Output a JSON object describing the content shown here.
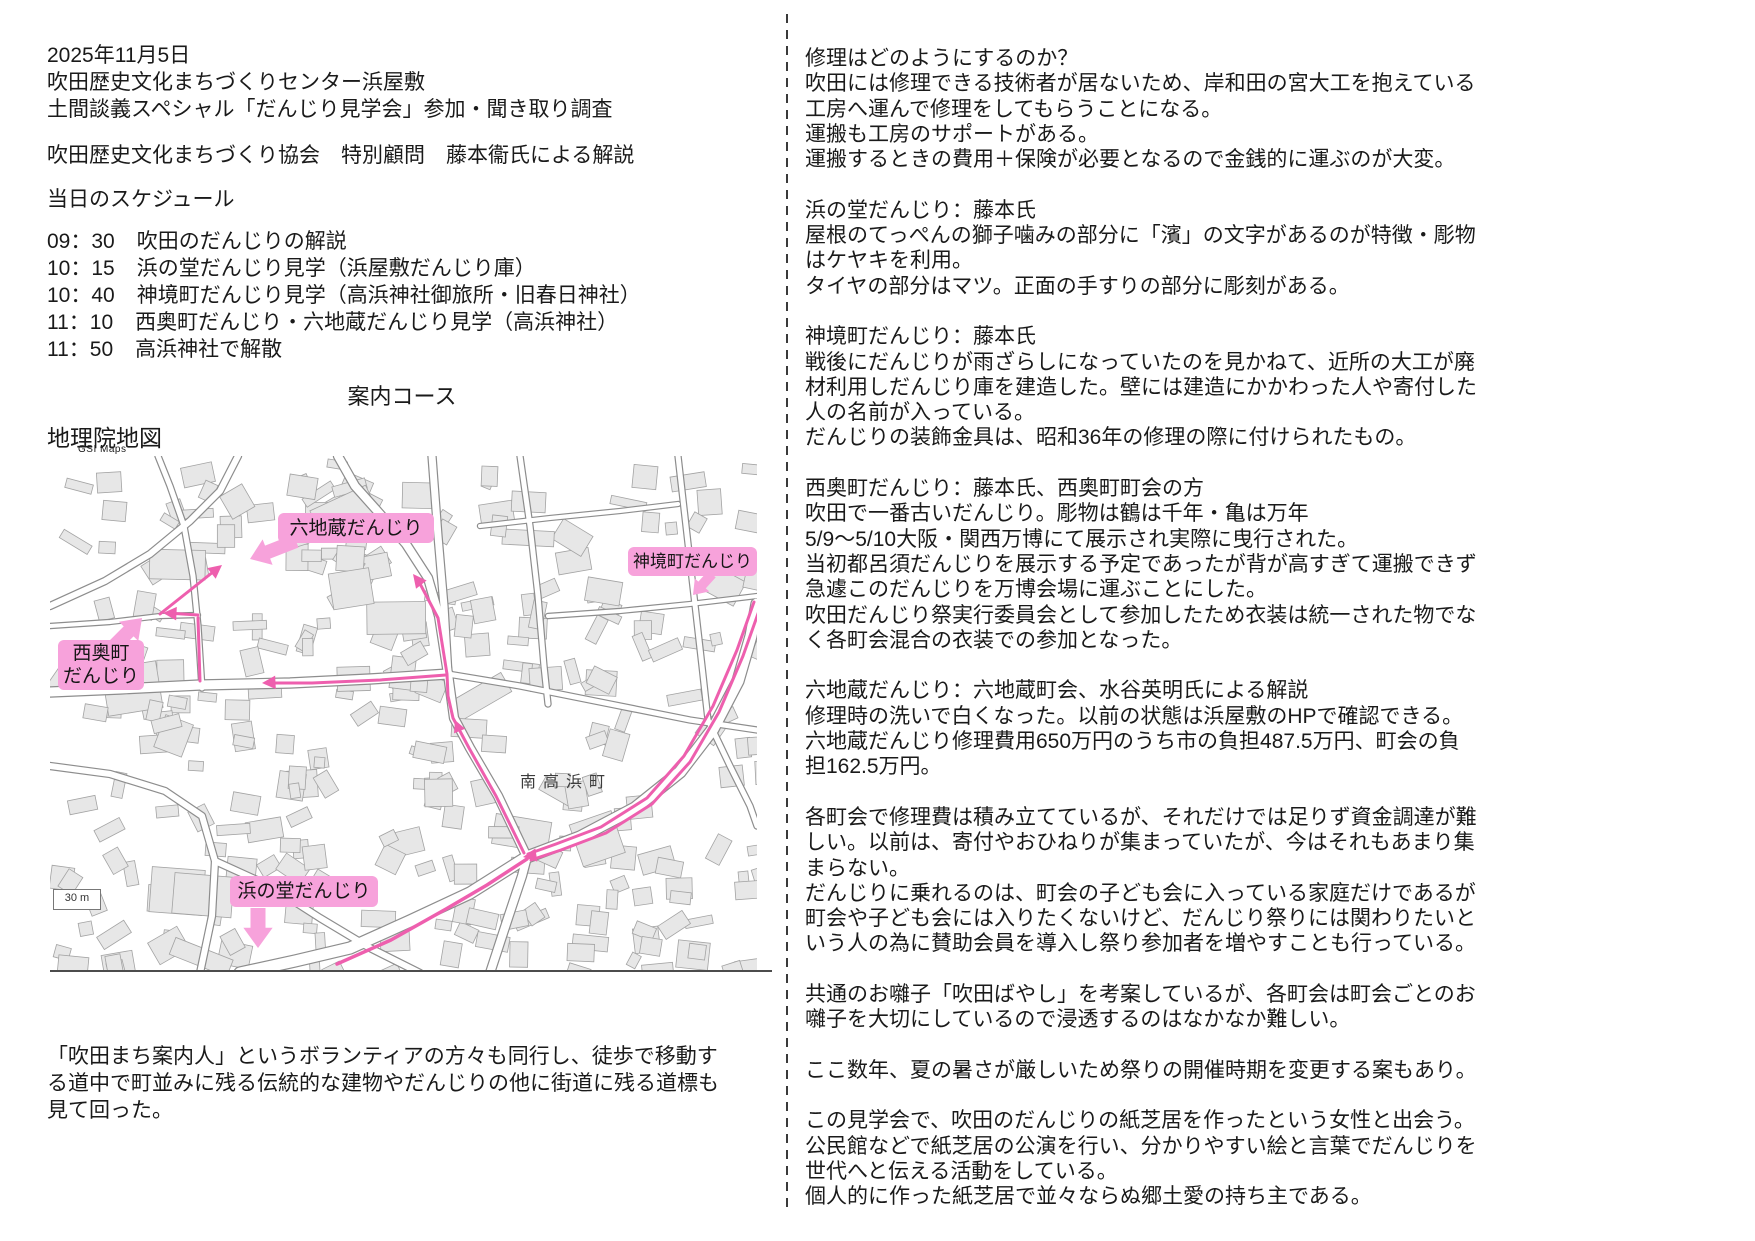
{
  "page": {
    "bg": "#ffffff"
  },
  "left": {
    "header_lines": [
      "2025年11月5日",
      "吹田歴史文化まちづくりセンター浜屋敷",
      "土間談義スペシャル「だんじり見学会」参加・聞き取り調査"
    ],
    "commentary_line": "吹田歴史文化まちづくり協会　特別顧問　藤本衞氏による解説",
    "schedule_title": "当日のスケジュール",
    "schedule": [
      {
        "time": "09：30",
        "item": "吹田のだんじりの解説"
      },
      {
        "time": "10：15",
        "item": "浜の堂だんじり見学（浜屋敷だんじり庫）"
      },
      {
        "time": "10：40",
        "item": "神境町だんじり見学（高浜神社御旅所・旧春日神社）"
      },
      {
        "time": "11：10",
        "item": "西奥町だんじり・六地蔵だんじり見学（高浜神社）"
      },
      {
        "time": "11：50",
        "item": "高浜神社で解散"
      }
    ],
    "course_title": "案内コース",
    "map_source_title": "地理院地図",
    "map_source_subtitle": "GSI Maps",
    "footer_paragraph": [
      "「吹田まち案内人」というボランティアの方々も同行し、徒歩で移動す",
      "る道中で町並みに残る伝統的な建物やだんじりの他に街道に残る道標も",
      "見て回った。"
    ]
  },
  "map": {
    "colors": {
      "background": "#ffffff",
      "building_fill": "#e7e7e7",
      "building_stroke": "#a3a3a3",
      "road_casing": "#8d8d8d",
      "road_fill": "#ffffff",
      "route": "#ee5fae",
      "label_bg": "#f7a2db",
      "label_text": "#151515"
    },
    "labels": [
      {
        "id": "rokujizo",
        "lines": [
          "六地蔵だんじり"
        ],
        "x": 228,
        "y": 57,
        "w": 156,
        "h": 30,
        "fs": 19
      },
      {
        "id": "shinkaicho",
        "lines": [
          "神境町だんじり"
        ],
        "x": 578,
        "y": 91,
        "w": 129,
        "h": 29,
        "fs": 17
      },
      {
        "id": "nishiokucho",
        "lines": [
          "西奥町",
          "だんじり"
        ],
        "x": 8,
        "y": 184,
        "w": 86,
        "h": 50,
        "fs": 19
      },
      {
        "id": "hamanodo",
        "lines": [
          "浜の堂だんじり"
        ],
        "x": 180,
        "y": 420,
        "w": 148,
        "h": 31,
        "fs": 19
      }
    ],
    "area_label": {
      "text": "南高浜町",
      "x": 470,
      "y": 312
    },
    "scale_label": {
      "text": "30 m",
      "x": 3,
      "y": 433,
      "w": 46,
      "h": 19
    },
    "roads": [
      {
        "pts": [
          [
            190,
            517
          ],
          [
            245,
            505
          ],
          [
            300,
            492
          ],
          [
            360,
            465
          ],
          [
            420,
            437
          ],
          [
            477,
            401
          ],
          [
            530,
            381
          ],
          [
            585,
            352
          ],
          [
            630,
            316
          ],
          [
            663,
            273
          ],
          [
            688,
            225
          ],
          [
            701,
            180
          ],
          [
            707,
            148
          ]
        ],
        "w": 11
      },
      {
        "pts": [
          [
            440,
            517
          ],
          [
            458,
            462
          ],
          [
            472,
            420
          ],
          [
            477,
            401
          ],
          [
            448,
            340
          ],
          [
            420,
            292
          ],
          [
            404,
            262
          ],
          [
            398,
            218
          ],
          [
            389,
            160
          ],
          [
            378,
            122
          ],
          [
            356,
            88
          ],
          [
            330,
            58
          ],
          [
            305,
            30
          ],
          [
            288,
            0
          ]
        ],
        "w": 8
      },
      {
        "pts": [
          [
            0,
            236
          ],
          [
            70,
            233
          ],
          [
            150,
            229
          ],
          [
            240,
            227
          ],
          [
            320,
            223
          ],
          [
            398,
            218
          ]
        ],
        "w": 9
      },
      {
        "pts": [
          [
            398,
            218
          ],
          [
            470,
            230
          ],
          [
            560,
            248
          ],
          [
            640,
            264
          ],
          [
            707,
            274
          ]
        ],
        "w": 5
      },
      {
        "pts": [
          [
            382,
            0
          ],
          [
            388,
            80
          ],
          [
            394,
            150
          ],
          [
            398,
            218
          ]
        ],
        "w": 7
      },
      {
        "pts": [
          [
            152,
            232
          ],
          [
            148,
            170
          ],
          [
            143,
            120
          ],
          [
            134,
            70
          ],
          [
            120,
            30
          ],
          [
            108,
            0
          ]
        ],
        "w": 5
      },
      {
        "pts": [
          [
            0,
            150
          ],
          [
            55,
            125
          ],
          [
            100,
            98
          ],
          [
            140,
            65
          ],
          [
            170,
            35
          ],
          [
            188,
            0
          ]
        ],
        "w": 6
      },
      {
        "pts": [
          [
            0,
            310
          ],
          [
            60,
            318
          ],
          [
            115,
            335
          ],
          [
            152,
            360
          ],
          [
            165,
            405
          ],
          [
            162,
            460
          ],
          [
            150,
            517
          ]
        ],
        "w": 6
      },
      {
        "pts": [
          [
            165,
            405
          ],
          [
            220,
            430
          ],
          [
            270,
            462
          ],
          [
            320,
            492
          ],
          [
            370,
            517
          ]
        ],
        "w": 6
      },
      {
        "pts": [
          [
            470,
            0
          ],
          [
            480,
            70
          ],
          [
            488,
            140
          ],
          [
            494,
            210
          ],
          [
            498,
            248
          ]
        ],
        "w": 5
      },
      {
        "pts": [
          [
            628,
            0
          ],
          [
            636,
            70
          ],
          [
            644,
            140
          ],
          [
            652,
            210
          ],
          [
            658,
            264
          ]
        ],
        "w": 5
      },
      {
        "pts": [
          [
            498,
            160
          ],
          [
            570,
            155
          ],
          [
            640,
            148
          ],
          [
            707,
            140
          ]
        ],
        "w": 4
      },
      {
        "pts": [
          [
            430,
            70
          ],
          [
            500,
            62
          ],
          [
            570,
            55
          ],
          [
            628,
            48
          ]
        ],
        "w": 4
      },
      {
        "pts": [
          [
            658,
            264
          ],
          [
            680,
            310
          ],
          [
            700,
            350
          ],
          [
            707,
            370
          ]
        ],
        "w": 5
      },
      {
        "pts": [
          [
            0,
            170
          ],
          [
            60,
            166
          ],
          [
            110,
            160
          ],
          [
            148,
            159
          ]
        ],
        "w": 4
      }
    ],
    "route_paths": [
      {
        "pts": [
          [
            704,
            146
          ],
          [
            687,
            194
          ],
          [
            663,
            250
          ],
          [
            634,
            300
          ],
          [
            597,
            342
          ],
          [
            551,
            371
          ],
          [
            506,
            388
          ],
          [
            478,
            398
          ]
        ],
        "w": 3
      },
      {
        "pts": [
          [
            710,
            152
          ],
          [
            693,
            200
          ],
          [
            669,
            256
          ],
          [
            640,
            306
          ],
          [
            602,
            348
          ],
          [
            556,
            377
          ],
          [
            511,
            394
          ],
          [
            481,
            404
          ]
        ],
        "w": 3
      },
      {
        "pts": [
          [
            477,
            403
          ],
          [
            437,
            429
          ],
          [
            396,
            453
          ],
          [
            341,
            484
          ],
          [
            287,
            508
          ]
        ],
        "w": 3.5
      },
      {
        "pts": [
          [
            474,
            397
          ],
          [
            446,
            340
          ],
          [
            419,
            292
          ],
          [
            403,
            262
          ],
          [
            398,
            240
          ],
          [
            397,
            218
          ],
          [
            388,
            162
          ],
          [
            367,
            122
          ]
        ],
        "w": 3
      },
      {
        "pts": [
          [
            396,
            219
          ],
          [
            330,
            224
          ],
          [
            262,
            227
          ],
          [
            216,
            227
          ]
        ],
        "w": 3
      },
      {
        "pts": [
          [
            150,
            225
          ],
          [
            148,
            162
          ]
        ],
        "w": 3
      },
      {
        "pts": [
          [
            148,
            159
          ],
          [
            117,
            157
          ]
        ],
        "w": 3
      },
      {
        "pts": [
          [
            110,
            158
          ],
          [
            168,
            112
          ]
        ],
        "w": 3
      }
    ],
    "route_arrowheads": [
      {
        "at": [
          363,
          118
        ],
        "dir": [
          -0.55,
          -0.7
        ],
        "s": 9
      },
      {
        "at": [
          405,
          264
        ],
        "dir": [
          -0.35,
          -0.85
        ],
        "s": 8
      },
      {
        "at": [
          212,
          227
        ],
        "dir": [
          -1,
          0.05
        ],
        "s": 9
      },
      {
        "at": [
          113,
          157
        ],
        "dir": [
          -1,
          -0.05
        ],
        "s": 9
      },
      {
        "at": [
          172,
          109
        ],
        "dir": [
          0.75,
          -0.6
        ],
        "s": 9
      },
      {
        "at": [
          473,
          401
        ],
        "dir": [
          -1,
          0.15
        ],
        "s": 9
      }
    ],
    "fat_arrows": [
      {
        "id": "rokujizo-pointer",
        "from": [
          246,
          85
        ],
        "to": [
          200,
          103
        ],
        "w": 14
      },
      {
        "id": "nishiokucho-pointer",
        "from": [
          58,
          196
        ],
        "to": [
          92,
          162
        ],
        "w": 14
      },
      {
        "id": "hamanodo-pointer",
        "from": [
          208,
          452
        ],
        "to": [
          208,
          492
        ],
        "w": 15
      },
      {
        "id": "shinkaicho-pointer",
        "from": [
          662,
          118
        ],
        "to": [
          643,
          139
        ],
        "w": 10
      }
    ]
  },
  "right": {
    "paragraphs": [
      [
        "修理はどのようにするのか？",
        "吹田には修理できる技術者が居ないため、岸和田の宮大工を抱えている",
        "工房へ運んで修理をしてもらうことになる。",
        "運搬も工房のサポートがある。",
        "運搬するときの費用＋保険が必要となるので金銭的に運ぶのが大変。"
      ],
      [
        "浜の堂だんじり：藤本氏",
        "屋根のてっぺんの獅子噛みの部分に「濱」の文字があるのが特徴・彫物",
        "はケヤキを利用。",
        "タイヤの部分はマツ。正面の手すりの部分に彫刻がある。"
      ],
      [
        "神境町だんじり：藤本氏",
        "戦後にだんじりが雨ざらしになっていたのを見かねて、近所の大工が廃",
        "材利用しだんじり庫を建造した。壁には建造にかかわった人や寄付した",
        "人の名前が入っている。",
        "だんじりの装飾金具は、昭和36年の修理の際に付けられたもの。"
      ],
      [
        "西奥町だんじり：藤本氏、西奥町町会の方",
        "吹田で一番古いだんじり。彫物は鶴は千年・亀は万年",
        "5/9～5/10大阪・関西万博にて展示され実際に曳行された。",
        "当初都呂須だんじりを展示する予定であったが背が高すぎて運搬できず",
        "急遽このだんじりを万博会場に運ぶことにした。",
        "吹田だんじり祭実行委員会として参加したため衣装は統一された物でな",
        "く各町会混合の衣装での参加となった。"
      ],
      [
        "六地蔵だんじり：六地蔵町会、水谷英明氏による解説",
        "修理時の洗いで白くなった。以前の状態は浜屋敷のHPで確認できる。",
        "六地蔵だんじり修理費用650万円のうち市の負担487.5万円、町会の負",
        "担162.5万円。"
      ],
      [
        "各町会で修理費は積み立てているが、それだけでは足りず資金調達が難",
        "しい。以前は、寄付やおひねりが集まっていたが、今はそれもあまり集",
        "まらない。",
        "だんじりに乗れるのは、町会の子ども会に入っている家庭だけであるが",
        "町会や子ども会には入りたくないけど、だんじり祭りには関わりたいと",
        "いう人の為に賛助会員を導入し祭り参加者を増やすことも行っている。"
      ],
      [
        "共通のお囃子「吹田ばやし」を考案しているが、各町会は町会ごとのお",
        "囃子を大切にしているので浸透するのはなかなか難しい。"
      ],
      [
        "ここ数年、夏の暑さが厳しいため祭りの開催時期を変更する案もあり。"
      ],
      [
        "この見学会で、吹田のだんじりの紙芝居を作ったという女性と出会う。",
        "公民館などで紙芝居の公演を行い、分かりやすい絵と言葉でだんじりを",
        "世代へと伝える活動をしている。",
        "個人的に作った紙芝居で並々ならぬ郷土愛の持ち主である。"
      ]
    ]
  }
}
